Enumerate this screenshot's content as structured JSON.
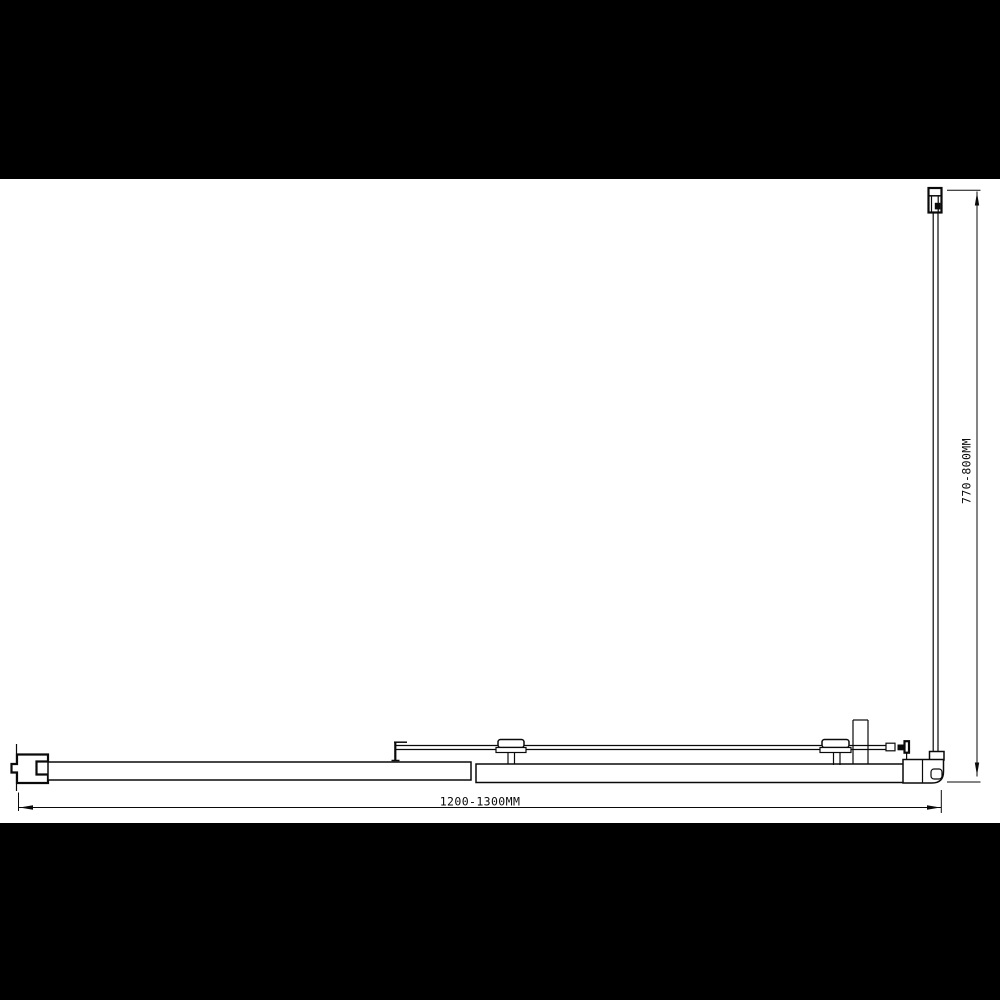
{
  "page": {
    "background_color": "#000000",
    "canvas_color": "#ffffff",
    "line_color": "#0a0a0a"
  },
  "diagram": {
    "type": "technical-drawing",
    "view": "plan",
    "width_dimension": {
      "label": "1200-1300MM"
    },
    "depth_dimension": {
      "label": "770-800MM"
    }
  }
}
